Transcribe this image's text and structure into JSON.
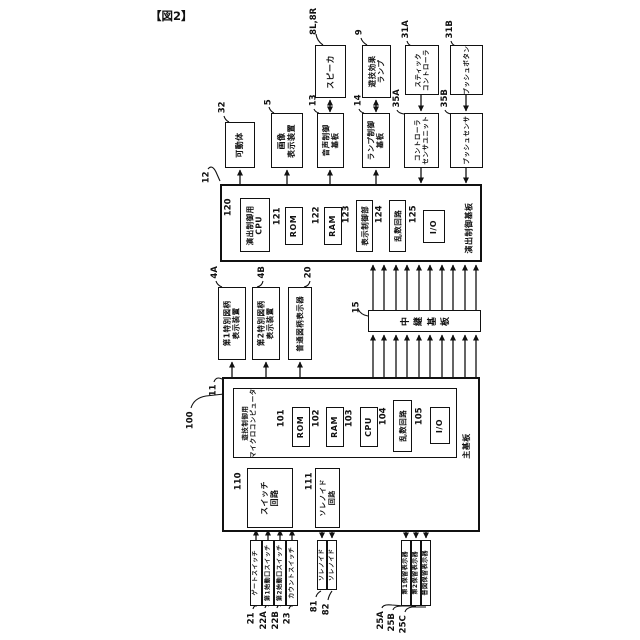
{
  "figure_label": "【図2】",
  "colors": {
    "line": "#111111",
    "background": "#ffffff"
  },
  "blocks": {
    "speaker": {
      "ref": "8L,8R",
      "label": "スピーカ"
    },
    "effect_lamp": {
      "ref": "9",
      "label": "遊技効果\nランプ"
    },
    "stick_controller": {
      "ref": "31A",
      "label": "スティック\nコントローラ"
    },
    "push_button": {
      "ref": "31B",
      "label": "プッシュボタン"
    },
    "movable_body": {
      "ref": "32",
      "label": "可動体"
    },
    "image_display": {
      "ref": "5",
      "label": "画像\n表示装置"
    },
    "audio_control_board": {
      "ref": "13",
      "label": "音声制御\n基板"
    },
    "lamp_control_board": {
      "ref": "14",
      "label": "ランプ制御\n基板"
    },
    "controller_sensor_unit": {
      "ref": "35A",
      "label": "コントローラ\nセンサユニット"
    },
    "push_sensor": {
      "ref": "35B",
      "label": "プッシュセンサ"
    },
    "effect_control_board": {
      "ref": "12",
      "label": "演出制御基板"
    },
    "effect_cpu": {
      "ref": "120",
      "label": "演出制御用\nCPU"
    },
    "effect_rom": {
      "ref": "121",
      "label": "ROM"
    },
    "effect_ram": {
      "ref": "122",
      "label": "RAM"
    },
    "display_control": {
      "ref": "123",
      "label": "表示制御部"
    },
    "effect_random": {
      "ref": "124",
      "label": "乱数回路"
    },
    "effect_io": {
      "ref": "125",
      "label": "I/O"
    },
    "special_display_1": {
      "ref": "4A",
      "label": "第1特別図柄\n表示装置"
    },
    "special_display_2": {
      "ref": "4B",
      "label": "第2特別図柄\n表示装置"
    },
    "normal_display": {
      "ref": "20",
      "label": "普通図柄表示器"
    },
    "relay_board": {
      "ref": "15",
      "label": "中継基板"
    },
    "main_board": {
      "ref": "11",
      "label": "主基板"
    },
    "game_micro": {
      "ref": "100",
      "label": "遊技制御用\nマイクロコンピュータ"
    },
    "main_rom": {
      "ref": "101",
      "label": "ROM"
    },
    "main_ram": {
      "ref": "102",
      "label": "RAM"
    },
    "main_cpu": {
      "ref": "103",
      "label": "CPU"
    },
    "main_random": {
      "ref": "104",
      "label": "乱数回路"
    },
    "main_io": {
      "ref": "105",
      "label": "I/O"
    },
    "switch_circuit": {
      "ref": "110",
      "label": "スイッチ\n回路"
    },
    "solenoid_circuit": {
      "ref": "111",
      "label": "ソレノイド\n回路"
    },
    "gate_switch": {
      "ref": "21",
      "label": "ゲートスイッチ"
    },
    "start_switch_1": {
      "ref": "22A",
      "label": "第1始動口スイッチ"
    },
    "start_switch_2": {
      "ref": "22B",
      "label": "第2始動口スイッチ"
    },
    "count_switch": {
      "ref": "23",
      "label": "カウントスイッチ"
    },
    "solenoid_81": {
      "ref": "81",
      "label": "ソレノイド"
    },
    "solenoid_82": {
      "ref": "82",
      "label": "ソレノイド"
    },
    "hold_display_1": {
      "ref": "25A",
      "label": "第1保留表示器"
    },
    "hold_display_2": {
      "ref": "25B",
      "label": "第2保留表示器"
    },
    "normal_hold_display": {
      "ref": "25C",
      "label": "普図保留表示器"
    }
  }
}
